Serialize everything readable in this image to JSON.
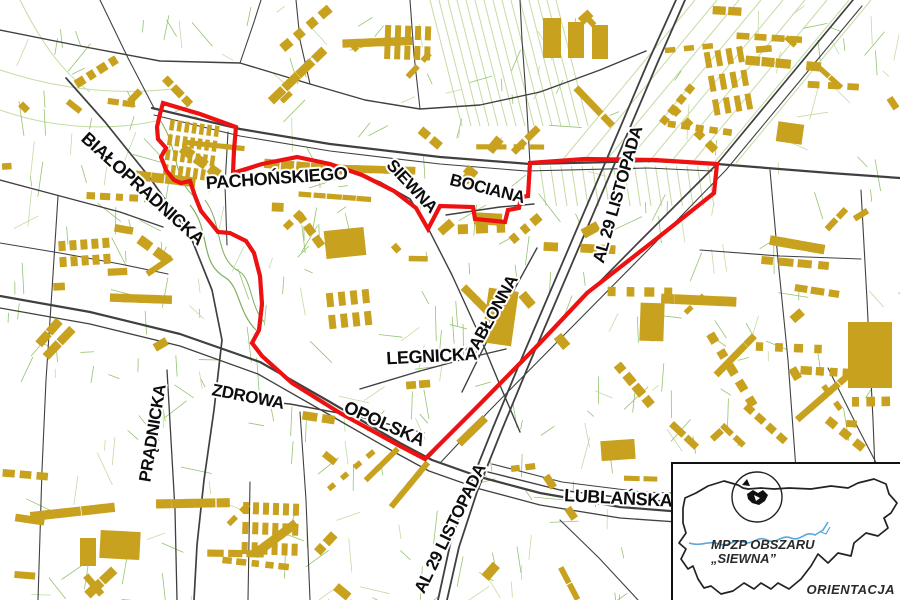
{
  "colors": {
    "background": "#ffffff",
    "boundary": "#ee1111",
    "building": "#c8a11e",
    "road": "#404040",
    "parcel_green": "#94c470",
    "parcel_green_pale": "#c3dca4",
    "park_green": "#7fae5a",
    "river": "#5aa8db",
    "label": "#0d0d0d",
    "label_halo": "#ffffff"
  },
  "map": {
    "street_labels": [
      {
        "text": "BIAŁOPRADNICKA",
        "x": 139,
        "y": 193,
        "rot": 42,
        "size": 18
      },
      {
        "text": "PACHOŃSKIEGO",
        "x": 277,
        "y": 184,
        "rot": -4,
        "size": 18
      },
      {
        "text": "SIEWNA",
        "x": 408,
        "y": 190,
        "rot": 47,
        "size": 17
      },
      {
        "text": "BOCIANA",
        "x": 486,
        "y": 194,
        "rot": 14,
        "size": 17
      },
      {
        "text": "AL 29 LISTOPADA",
        "x": 623,
        "y": 196,
        "rot": -74,
        "size": 17
      },
      {
        "text": "JABŁONNA",
        "x": 496,
        "y": 319,
        "rot": -61,
        "size": 17
      },
      {
        "text": "LEGNICKA",
        "x": 432,
        "y": 362,
        "rot": -3,
        "size": 18
      },
      {
        "text": "OPOLSKA",
        "x": 382,
        "y": 429,
        "rot": 24,
        "size": 18
      },
      {
        "text": "ZDROWA",
        "x": 247,
        "y": 402,
        "rot": 11,
        "size": 17
      },
      {
        "text": "PRĄDNICKA",
        "x": 158,
        "y": 434,
        "rot": -81,
        "size": 17
      },
      {
        "text": "AL 29 LISTOPADA",
        "x": 455,
        "y": 531,
        "rot": -64,
        "size": 17
      },
      {
        "text": "LUBLAŃSKA",
        "x": 618,
        "y": 504,
        "rot": 3,
        "size": 18
      }
    ],
    "plan_boundary": [
      [
        163,
        103
      ],
      [
        200,
        114
      ],
      [
        236,
        127
      ],
      [
        234,
        150
      ],
      [
        233,
        173
      ],
      [
        262,
        164
      ],
      [
        297,
        157
      ],
      [
        330,
        164
      ],
      [
        362,
        175
      ],
      [
        394,
        191
      ],
      [
        416,
        208
      ],
      [
        428,
        229
      ],
      [
        440,
        206
      ],
      [
        473,
        207
      ],
      [
        475,
        219
      ],
      [
        505,
        222
      ],
      [
        508,
        210
      ],
      [
        519,
        208
      ],
      [
        521,
        197
      ],
      [
        528,
        196
      ],
      [
        530,
        163
      ],
      [
        585,
        159
      ],
      [
        655,
        160
      ],
      [
        717,
        164
      ],
      [
        714,
        193
      ],
      [
        655,
        240
      ],
      [
        587,
        293
      ],
      [
        540,
        343
      ],
      [
        480,
        404
      ],
      [
        425,
        459
      ],
      [
        400,
        446
      ],
      [
        340,
        413
      ],
      [
        292,
        383
      ],
      [
        262,
        356
      ],
      [
        252,
        343
      ],
      [
        259,
        330
      ],
      [
        262,
        304
      ],
      [
        260,
        276
      ],
      [
        254,
        253
      ],
      [
        246,
        241
      ],
      [
        230,
        233
      ],
      [
        218,
        232
      ],
      [
        210,
        222
      ],
      [
        201,
        211
      ],
      [
        195,
        196
      ],
      [
        190,
        181
      ],
      [
        181,
        183
      ],
      [
        174,
        180
      ],
      [
        166,
        170
      ],
      [
        161,
        157
      ],
      [
        166,
        148
      ],
      [
        158,
        139
      ],
      [
        157,
        127
      ],
      [
        160,
        114
      ]
    ],
    "roads": [
      {
        "w": 2.2,
        "pts": [
          [
            152,
            108
          ],
          [
            240,
            129
          ],
          [
            330,
            144
          ],
          [
            440,
            157
          ],
          [
            530,
            164
          ],
          [
            650,
            161
          ],
          [
            717,
            164
          ],
          [
            830,
            173
          ],
          [
            900,
            178
          ]
        ]
      },
      {
        "w": 1.1,
        "pts": [
          [
            154,
            115
          ],
          [
            240,
            136
          ],
          [
            330,
            151
          ],
          [
            440,
            164
          ],
          [
            526,
            171
          ],
          [
            648,
            168
          ],
          [
            712,
            171
          ]
        ]
      },
      {
        "w": 1.7,
        "pts": [
          [
            853,
            0
          ],
          [
            780,
            88
          ],
          [
            717,
            164
          ],
          [
            640,
            241
          ],
          [
            560,
            322
          ],
          [
            480,
            403
          ],
          [
            430,
            456
          ]
        ]
      },
      {
        "w": 1.1,
        "pts": [
          [
            862,
            6
          ],
          [
            789,
            94
          ],
          [
            726,
            170
          ],
          [
            649,
            249
          ],
          [
            569,
            330
          ],
          [
            489,
            411
          ],
          [
            441,
            462
          ]
        ]
      },
      {
        "w": 1.8,
        "pts": [
          [
            676,
            0
          ],
          [
            648,
            62
          ],
          [
            617,
            135
          ],
          [
            585,
            210
          ],
          [
            553,
            285
          ],
          [
            521,
            360
          ],
          [
            492,
            430
          ],
          [
            468,
            490
          ],
          [
            450,
            545
          ],
          [
            438,
            600
          ]
        ]
      },
      {
        "w": 1.8,
        "pts": [
          [
            685,
            0
          ],
          [
            657,
            64
          ],
          [
            626,
            137
          ],
          [
            594,
            212
          ],
          [
            562,
            287
          ],
          [
            530,
            362
          ],
          [
            501,
            432
          ],
          [
            477,
            492
          ],
          [
            459,
            547
          ],
          [
            447,
            600
          ]
        ]
      },
      {
        "w": 1.7,
        "pts": [
          [
            233,
            175
          ],
          [
            262,
            165
          ],
          [
            298,
            158
          ],
          [
            340,
            167
          ],
          [
            380,
            182
          ],
          [
            410,
            199
          ],
          [
            428,
            228
          ]
        ]
      },
      {
        "w": 1.4,
        "pts": [
          [
            428,
            228
          ],
          [
            452,
            275
          ],
          [
            478,
            332
          ],
          [
            502,
            390
          ],
          [
            520,
            432
          ]
        ]
      },
      {
        "w": 1.7,
        "pts": [
          [
            66,
            78
          ],
          [
            105,
            122
          ],
          [
            150,
            178
          ],
          [
            190,
            235
          ],
          [
            212,
            290
          ],
          [
            222,
            340
          ],
          [
            214,
            410
          ],
          [
            204,
            480
          ],
          [
            197,
            545
          ],
          [
            194,
            600
          ]
        ]
      },
      {
        "w": 1.3,
        "pts": [
          [
            167,
            370
          ],
          [
            171,
            440
          ],
          [
            175,
            510
          ],
          [
            177,
            600
          ]
        ]
      },
      {
        "w": 2.2,
        "pts": [
          [
            0,
            296
          ],
          [
            90,
            312
          ],
          [
            180,
            334
          ],
          [
            260,
            362
          ],
          [
            330,
            402
          ],
          [
            400,
            443
          ],
          [
            432,
            460
          ],
          [
            480,
            477
          ],
          [
            540,
            493
          ],
          [
            620,
            507
          ],
          [
            720,
            515
          ],
          [
            900,
            526
          ]
        ]
      },
      {
        "w": 1.3,
        "pts": [
          [
            0,
            308
          ],
          [
            90,
            324
          ],
          [
            180,
            346
          ],
          [
            258,
            374
          ],
          [
            328,
            414
          ],
          [
            396,
            453
          ],
          [
            429,
            471
          ],
          [
            480,
            489
          ],
          [
            540,
            505
          ],
          [
            620,
            518
          ],
          [
            720,
            525
          ],
          [
            900,
            535
          ]
        ]
      },
      {
        "w": 1.4,
        "pts": [
          [
            488,
            472
          ],
          [
            560,
            490
          ],
          [
            640,
            500
          ],
          [
            730,
            503
          ],
          [
            830,
            498
          ],
          [
            900,
            495
          ]
        ]
      },
      {
        "w": 1.1,
        "pts": [
          [
            492,
            464
          ],
          [
            562,
            482
          ],
          [
            642,
            492
          ],
          [
            732,
            495
          ],
          [
            832,
            490
          ],
          [
            900,
            487
          ]
        ]
      },
      {
        "w": 1.4,
        "pts": [
          [
            212,
            396
          ],
          [
            290,
            404
          ],
          [
            360,
            417
          ],
          [
            424,
            433
          ]
        ]
      },
      {
        "w": 1.4,
        "pts": [
          [
            360,
            389
          ],
          [
            420,
            371
          ],
          [
            472,
            357
          ],
          [
            506,
            349
          ]
        ]
      },
      {
        "w": 1.4,
        "pts": [
          [
            446,
            215
          ],
          [
            500,
            207
          ],
          [
            534,
            204
          ]
        ]
      },
      {
        "w": 1.4,
        "pts": [
          [
            462,
            392
          ],
          [
            481,
            353
          ],
          [
            500,
            316
          ],
          [
            520,
            279
          ],
          [
            537,
            248
          ]
        ]
      },
      {
        "w": 1.4,
        "pts": [
          [
            0,
            30
          ],
          [
            80,
            46
          ],
          [
            160,
            61
          ],
          [
            240,
            63
          ],
          [
            310,
            84
          ],
          [
            365,
            100
          ],
          [
            420,
            109
          ],
          [
            480,
            105
          ],
          [
            540,
            92
          ],
          [
            600,
            70
          ],
          [
            646,
            51
          ]
        ]
      },
      {
        "w": 1.1,
        "pts": [
          [
            240,
            63
          ],
          [
            254,
            22
          ],
          [
            261,
            0
          ]
        ]
      },
      {
        "w": 1.1,
        "pts": [
          [
            310,
            84
          ],
          [
            300,
            40
          ],
          [
            296,
            0
          ]
        ]
      },
      {
        "w": 1.1,
        "pts": [
          [
            420,
            109
          ],
          [
            414,
            55
          ],
          [
            410,
            0
          ]
        ]
      },
      {
        "w": 1.4,
        "pts": [
          [
            0,
            180
          ],
          [
            60,
            196
          ],
          [
            120,
            212
          ],
          [
            163,
            227
          ]
        ]
      },
      {
        "w": 1.1,
        "pts": [
          [
            0,
            243
          ],
          [
            60,
            253
          ],
          [
            120,
            264
          ],
          [
            168,
            274
          ]
        ]
      },
      {
        "w": 1.1,
        "pts": [
          [
            58,
            196
          ],
          [
            52,
            290
          ],
          [
            46,
            380
          ],
          [
            42,
            470
          ],
          [
            38,
            600
          ]
        ]
      },
      {
        "w": 1.1,
        "pts": [
          [
            100,
            0
          ],
          [
            128,
            58
          ],
          [
            154,
            108
          ]
        ]
      },
      {
        "w": 1.1,
        "pts": [
          [
            770,
            170
          ],
          [
            778,
            260
          ],
          [
            788,
            360
          ],
          [
            796,
            470
          ],
          [
            800,
            600
          ]
        ]
      },
      {
        "w": 1.1,
        "pts": [
          [
            861,
            190
          ],
          [
            867,
            300
          ],
          [
            873,
            420
          ],
          [
            877,
            520
          ]
        ]
      },
      {
        "w": 1.1,
        "pts": [
          [
            700,
            250
          ],
          [
            780,
            256
          ],
          [
            861,
            259
          ]
        ]
      },
      {
        "w": 1.1,
        "pts": [
          [
            300,
            412
          ],
          [
            306,
            500
          ],
          [
            310,
            600
          ]
        ]
      },
      {
        "w": 1.1,
        "pts": [
          [
            250,
            482
          ],
          [
            248,
            600
          ]
        ]
      },
      {
        "w": 1.1,
        "pts": [
          [
            560,
            520
          ],
          [
            599,
            558
          ],
          [
            638,
            600
          ]
        ]
      },
      {
        "w": 1.1,
        "pts": [
          [
            530,
            164
          ],
          [
            527,
            110
          ],
          [
            522,
            40
          ],
          [
            520,
            0
          ]
        ]
      },
      {
        "w": 1.1,
        "pts": [
          [
            828,
            368
          ],
          [
            858,
            428
          ],
          [
            884,
            478
          ],
          [
            900,
            504
          ]
        ]
      },
      {
        "w": 1.1,
        "pts": [
          [
            228,
            132
          ],
          [
            225,
            185
          ],
          [
            227,
            245
          ]
        ]
      }
    ],
    "large_buildings": [
      [
        345,
        243,
        40,
        28,
        -6
      ],
      [
        488,
        219,
        28,
        12,
        3
      ],
      [
        500,
        317,
        30,
        55,
        8
      ],
      [
        870,
        355,
        44,
        66,
        0
      ],
      [
        120,
        545,
        40,
        28,
        3
      ],
      [
        88,
        552,
        16,
        28,
        0
      ],
      [
        552,
        38,
        18,
        40,
        0
      ],
      [
        576,
        40,
        16,
        36,
        0
      ],
      [
        600,
        42,
        16,
        34,
        0
      ],
      [
        790,
        133,
        26,
        20,
        8
      ],
      [
        618,
        450,
        34,
        20,
        -4
      ],
      [
        652,
        322,
        24,
        38,
        2
      ]
    ],
    "row_blocks": [
      {
        "x": 172,
        "y": 125,
        "cols": 7,
        "step": 7.5,
        "w": 4.5,
        "h": 11,
        "rows": 4,
        "rowstep": 15,
        "rot": 8
      },
      {
        "x": 388,
        "y": 32,
        "cols": 5,
        "step": 10,
        "w": 6,
        "h": 14,
        "rows": 2,
        "rowstep": 20,
        "rot": 2
      },
      {
        "x": 62,
        "y": 246,
        "cols": 5,
        "step": 11,
        "w": 7,
        "h": 10,
        "rows": 2,
        "rowstep": 16,
        "rot": -4
      },
      {
        "x": 708,
        "y": 60,
        "cols": 4,
        "step": 11,
        "w": 6,
        "h": 16,
        "rows": 3,
        "rowstep": 24,
        "rot": -10
      },
      {
        "x": 246,
        "y": 508,
        "cols": 6,
        "step": 10,
        "w": 6,
        "h": 12,
        "rows": 3,
        "rowstep": 20,
        "rot": 2
      },
      {
        "x": 330,
        "y": 300,
        "cols": 4,
        "step": 12,
        "w": 7,
        "h": 14,
        "rows": 2,
        "rowstep": 22,
        "rot": -6
      }
    ]
  },
  "inset": {
    "title_line1": "MPZP OBSZARU",
    "title_line2": "„SIEWNA”",
    "caption": "ORIENTACJA"
  }
}
